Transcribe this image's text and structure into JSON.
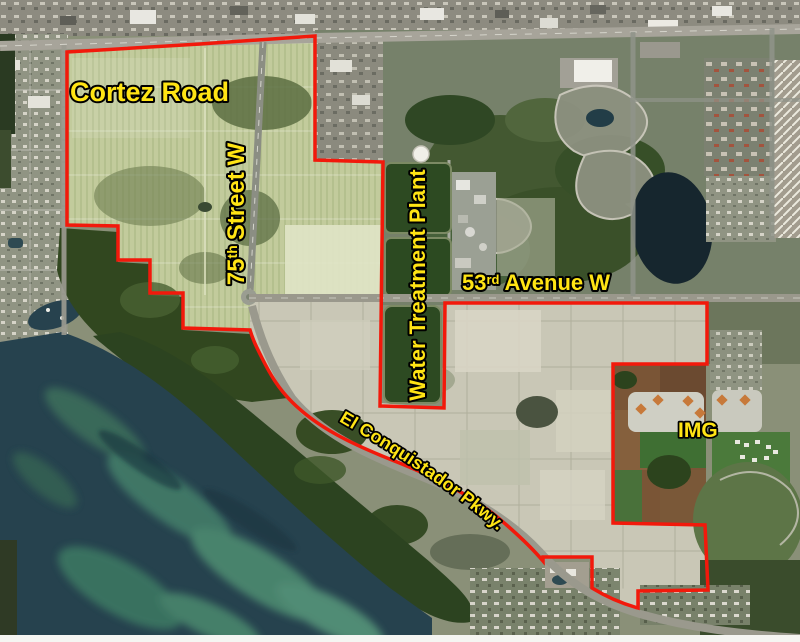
{
  "map": {
    "labels": {
      "cortez_road": "Cortez Road",
      "street_75": {
        "base": "75",
        "sup": "th",
        "rest": "Street W"
      },
      "water_treatment_plant": "Water Treatment Plant",
      "avenue_53": {
        "base": "53",
        "sup": "rd",
        "rest": "Avenue W"
      },
      "el_conquistador": "El Conquistador Pkwy.",
      "img": "IMG"
    },
    "colors": {
      "boundary_red": "#f2190b",
      "label_yellow": "#ffe414"
    }
  }
}
